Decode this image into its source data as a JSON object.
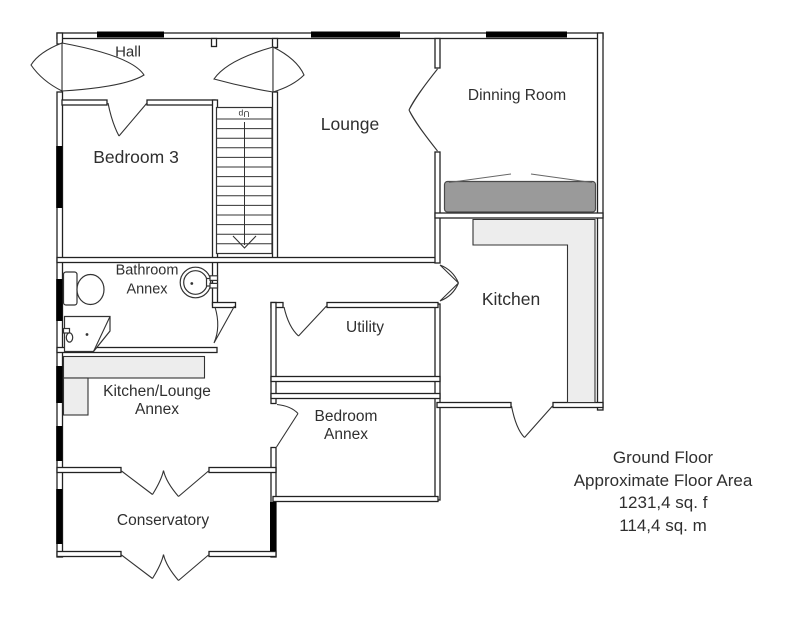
{
  "page": {
    "title": "Ground floor plan",
    "background": "#ffffff"
  },
  "rooms": {
    "hall": {
      "label": "Hall"
    },
    "bedroom3": {
      "label": "Bedroom 3"
    },
    "lounge": {
      "label": "Lounge"
    },
    "dinning_room": {
      "label": "Dinning Room"
    },
    "bathroom_annex": {
      "line1": "Bathroom",
      "line2": "Annex"
    },
    "kitchen": {
      "label": "Kitchen"
    },
    "utility": {
      "label": "Utility"
    },
    "kitchen_lounge_annex": {
      "line1": "Kitchen/Lounge",
      "line2": "Annex"
    },
    "bedroom_annex": {
      "line1": "Bedroom",
      "line2": "Annex"
    },
    "conservatory": {
      "label": "Conservatory"
    }
  },
  "stairs": {
    "direction_label": "Up"
  },
  "summary": {
    "line1": "Ground Floor",
    "line2": "Approximate Floor Area",
    "line3": "1231,4 sq. f",
    "line4": "114,4 sq. m"
  },
  "colors": {
    "wall_line": "#222222",
    "window_bar": "#000000",
    "counter_fill": "#ededed",
    "furniture_dark_fill": "#9a9a9a",
    "text": "#2f2f2f"
  }
}
